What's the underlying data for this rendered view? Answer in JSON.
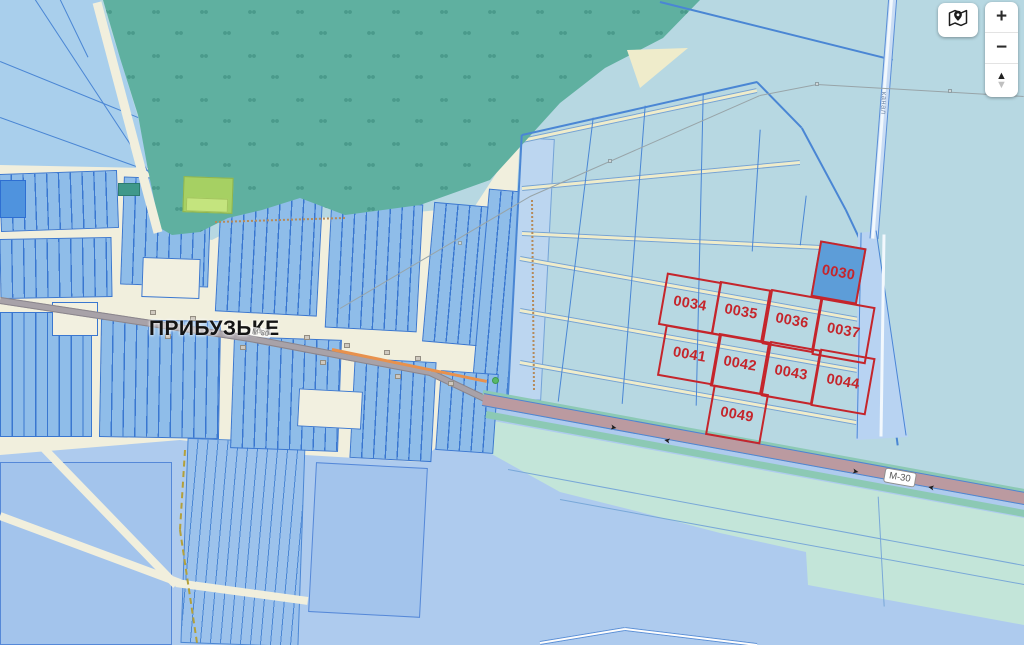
{
  "map": {
    "village_label": "ПРИБУЗЬКЕ",
    "highway_badge": "М-30",
    "road_small_label": "М-30",
    "canal_label": "канал",
    "parcels": [
      {
        "id": "0030",
        "filled": true
      },
      {
        "id": "0034",
        "filled": false
      },
      {
        "id": "0035",
        "filled": false
      },
      {
        "id": "0036",
        "filled": false
      },
      {
        "id": "0037",
        "filled": false
      },
      {
        "id": "0041",
        "filled": false
      },
      {
        "id": "0042",
        "filled": false
      },
      {
        "id": "0043",
        "filled": false
      },
      {
        "id": "0044",
        "filled": false
      },
      {
        "id": "0049",
        "filled": false
      }
    ]
  },
  "controls": {
    "zoom_in_label": "+",
    "zoom_out_label": "−",
    "compass_up_glyph": "▲",
    "compass_down_glyph": "▼",
    "icons": {
      "map_button": "map-pin-icon",
      "compass": "compass-icon"
    }
  },
  "colors": {
    "field_cyan": "#b7d8e2",
    "parcel_red": "#c5252b",
    "parcel_fill_blue": "#5d9dd8",
    "forest_green": "#5fb0a0",
    "village_block_blue": "#8fbde9",
    "village_line_blue": "#3a77d0",
    "street_cream": "#f1efdd",
    "village_road_gray": "#a8a2a8",
    "highway_mauve": "#bb9aa0",
    "roadside_mint": "#c3e5d9",
    "bottom_field_blue": "#aecbee",
    "canal_band_blue": "#b8d3f2"
  }
}
